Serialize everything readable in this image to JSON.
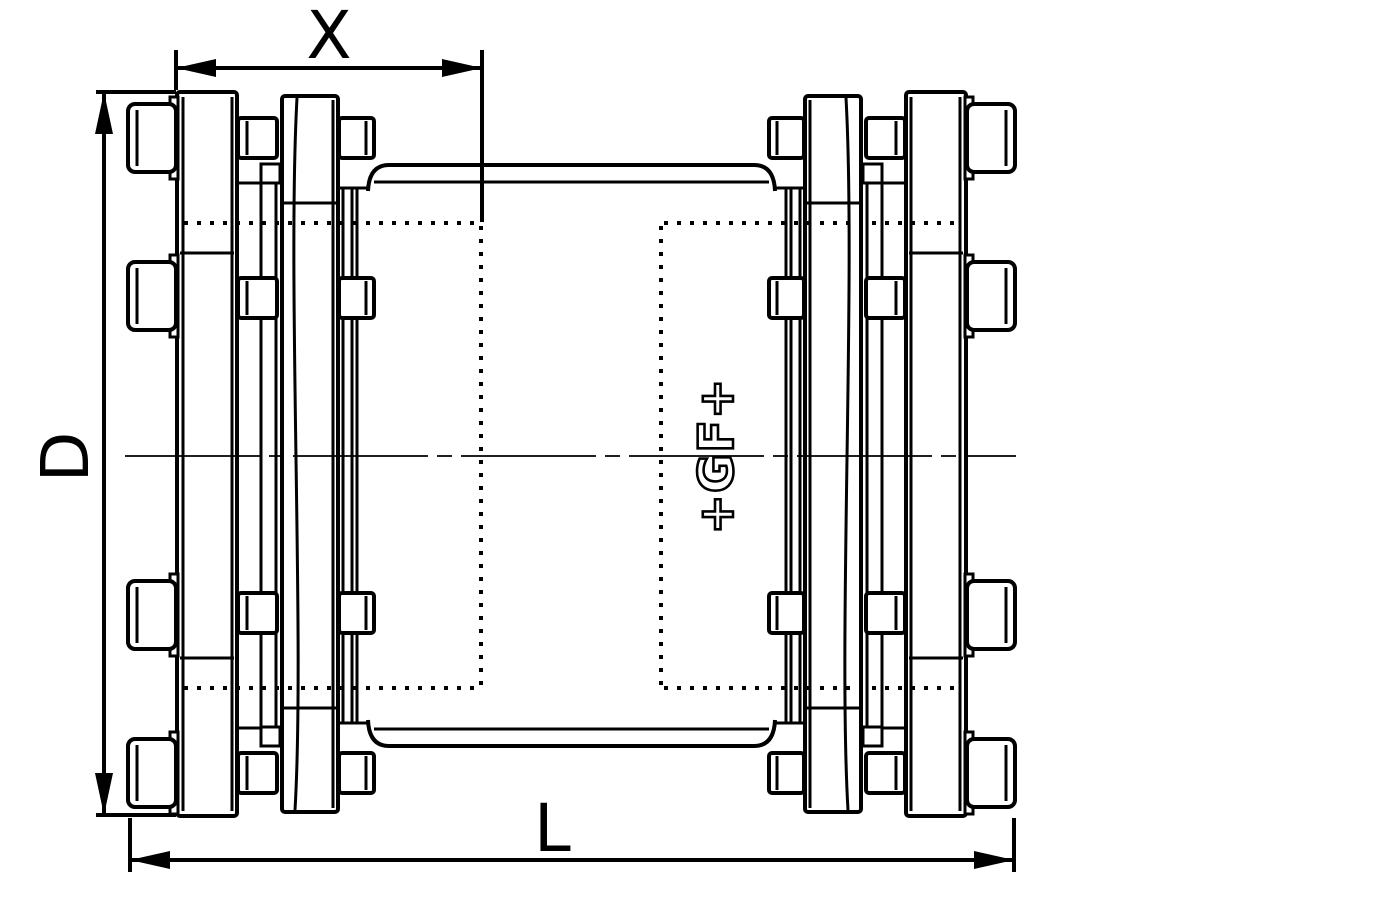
{
  "drawing": {
    "description": "technical line drawing of a bolted pipe coupling, side view",
    "labels": {
      "insertion_depth": "X",
      "diameter": "D",
      "overall_length": "L"
    },
    "logo": "+GF+",
    "colors": {
      "line": "#000000",
      "background": "#ffffff"
    }
  }
}
